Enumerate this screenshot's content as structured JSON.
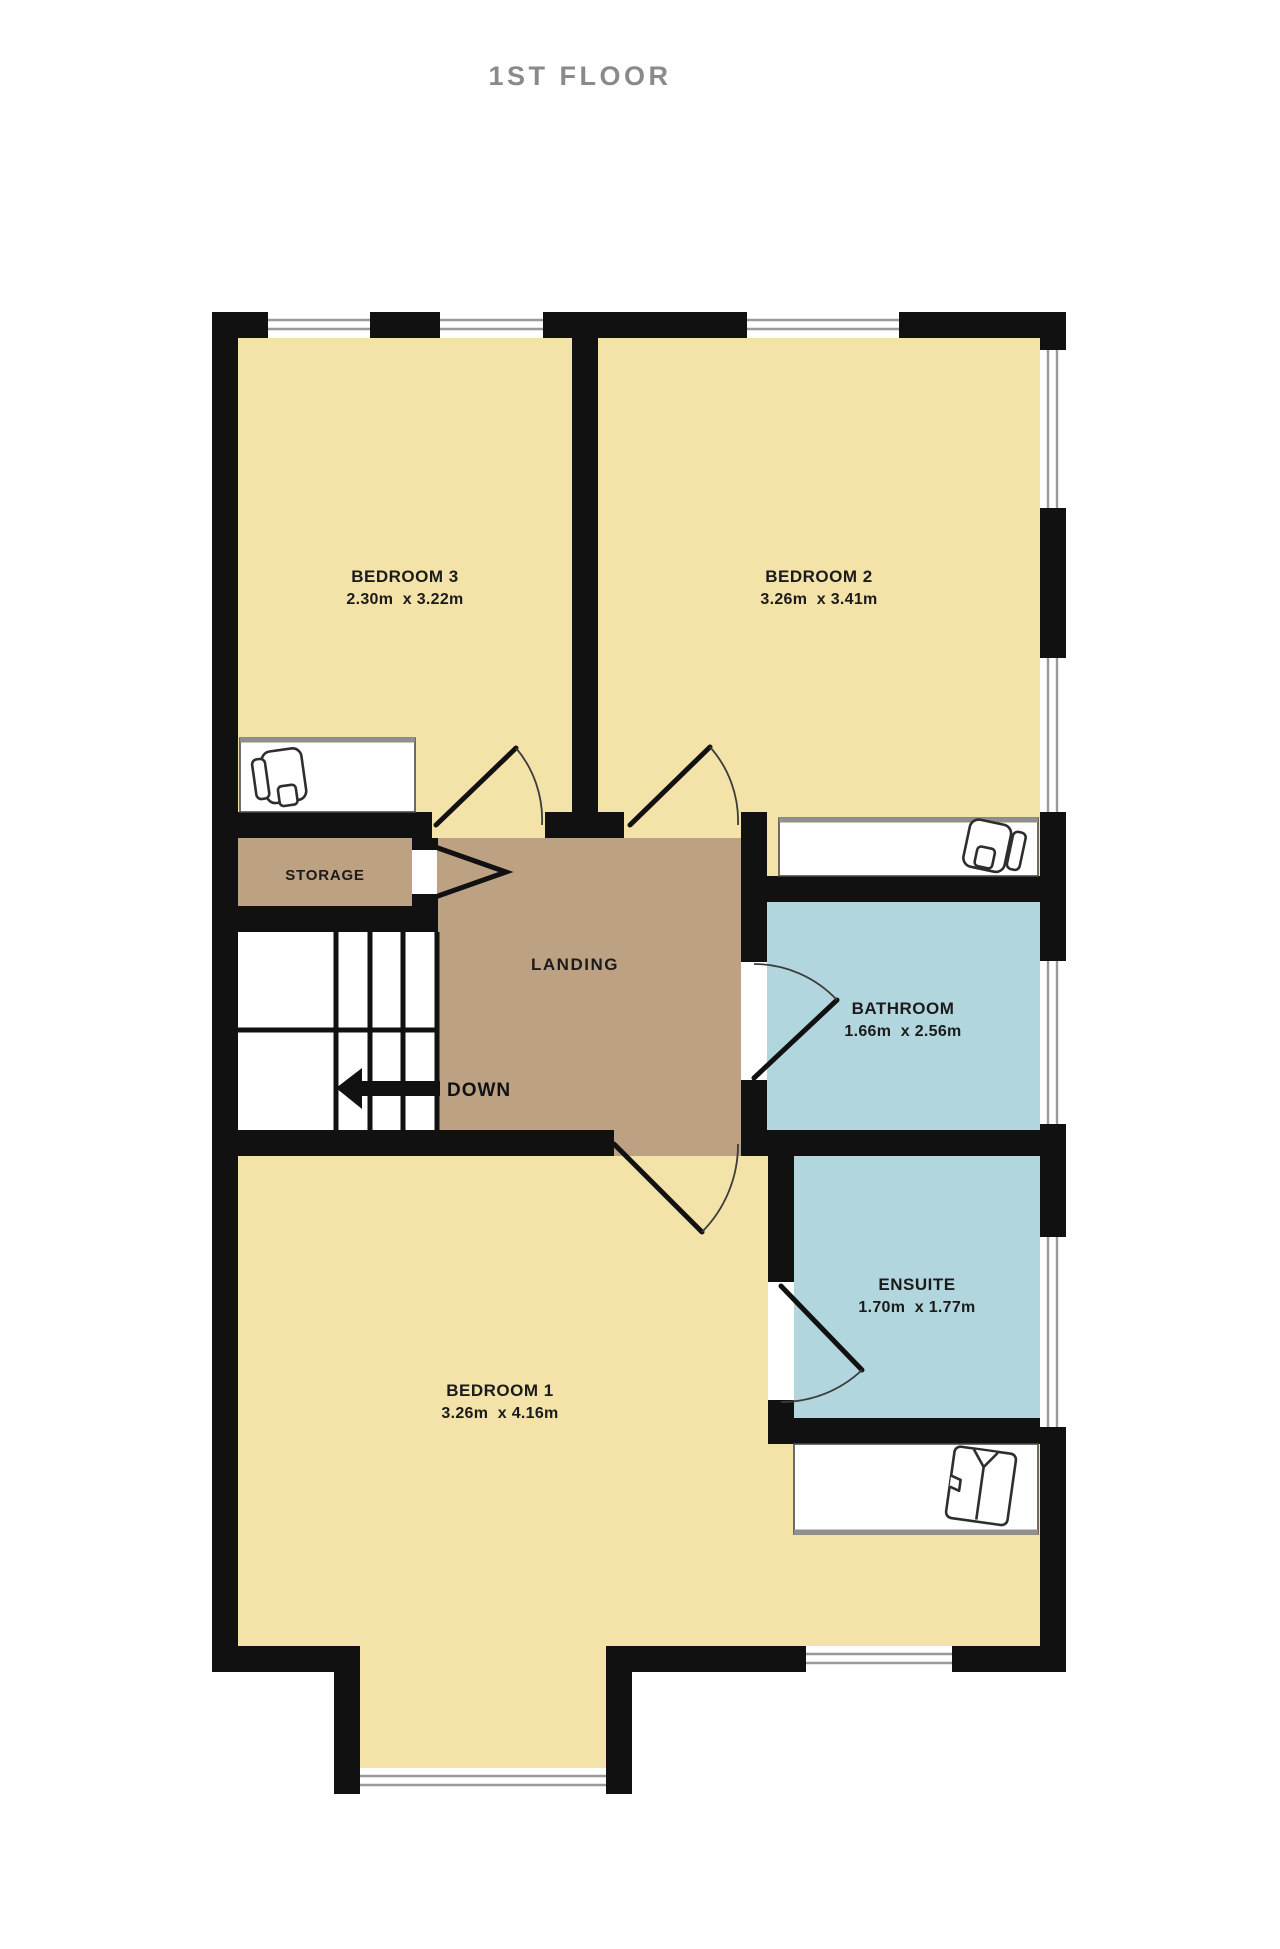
{
  "title": "1ST FLOOR",
  "colors": {
    "bedroom_fill": "#F3E3A9",
    "hall_fill": "#BCA183",
    "wet_room_fill": "#B2D6DD",
    "wall": "#111111",
    "window_line": "#9A9A9A",
    "title_text": "#8A8A8A",
    "label_text": "#1B1B1B"
  },
  "rooms": {
    "bedroom3": {
      "name": "BEDROOM 3",
      "dims": "2.30m  x 3.22m"
    },
    "bedroom2": {
      "name": "BEDROOM 2",
      "dims": "3.26m  x 3.41m"
    },
    "bedroom1": {
      "name": "BEDROOM 1",
      "dims": "3.26m  x 4.16m"
    },
    "bathroom": {
      "name": "BATHROOM",
      "dims": "1.66m  x 2.56m"
    },
    "ensuite": {
      "name": "ENSUITE",
      "dims": "1.70m  x 1.77m"
    },
    "storage": {
      "name": "STORAGE"
    },
    "landing": {
      "name": "LANDING"
    }
  },
  "stairs": {
    "label": "DOWN"
  }
}
